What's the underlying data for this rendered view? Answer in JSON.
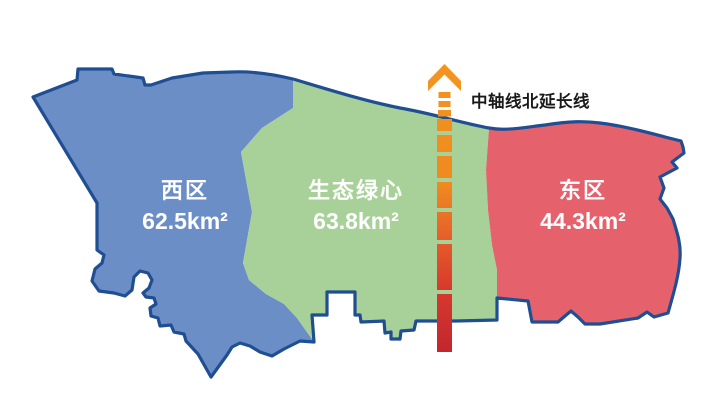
{
  "title": "district-area-map",
  "background": "#FFFFFF",
  "outline_color": "#1F4E92",
  "regions": [
    {
      "id": "west",
      "name": "西区",
      "area": "62.5km²",
      "fill": "#6C8EC7"
    },
    {
      "id": "center",
      "name": "生态绿心",
      "area": "63.8km²",
      "fill": "#A8D199"
    },
    {
      "id": "east",
      "name": "东区",
      "area": "44.3km²",
      "fill": "#E5626D"
    }
  ],
  "axis": {
    "label": "中轴线北延长线",
    "label_color": "#1A1A1A",
    "colors": [
      "#F2951F",
      "#EF8A1F",
      "#E6602A",
      "#D8392D",
      "#C2272E"
    ]
  }
}
